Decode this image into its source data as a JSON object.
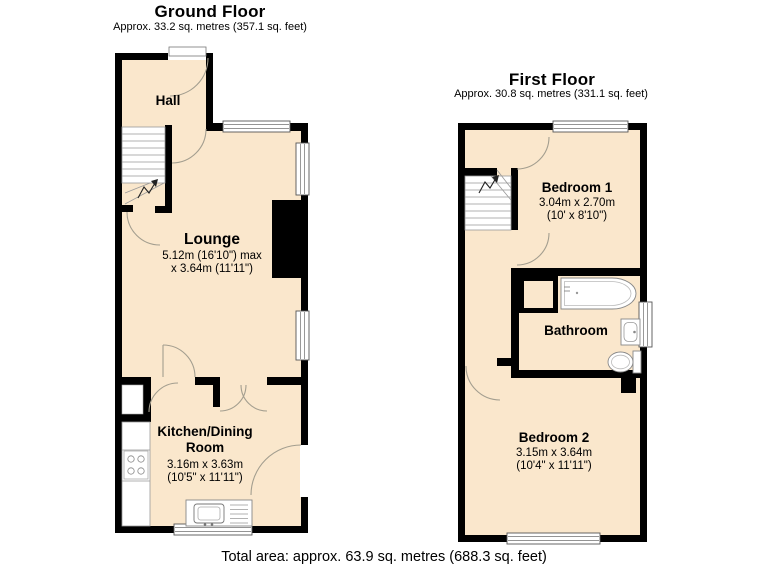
{
  "ground_floor": {
    "title": "Ground Floor",
    "subtitle": "Approx. 33.2 sq. metres (357.1 sq. feet)",
    "hall": {
      "name": "Hall"
    },
    "lounge": {
      "name": "Lounge",
      "dim1": "5.12m (16'10\") max",
      "dim2": "x 3.64m (11'11\")"
    },
    "kitchen": {
      "name": "Kitchen/Dining Room",
      "dim1": "3.16m x 3.63m",
      "dim2": "(10'5\" x 11'11\")"
    }
  },
  "first_floor": {
    "title": "First Floor",
    "subtitle": "Approx. 30.8 sq. metres (331.1 sq. feet)",
    "bedroom1": {
      "name": "Bedroom 1",
      "dim1": "3.04m x 2.70m",
      "dim2": "(10' x 8'10\")"
    },
    "bathroom": {
      "name": "Bathroom"
    },
    "bedroom2": {
      "name": "Bedroom 2",
      "dim1": "3.15m x 3.64m",
      "dim2": "(10'4\" x 11'11\")"
    }
  },
  "footer": {
    "total_area": "Total area: approx. 63.9 sq. metres (688.3 sq. feet)"
  },
  "colors": {
    "floor_fill": "#fae7cc",
    "wall": "#000000",
    "background": "#ffffff"
  }
}
